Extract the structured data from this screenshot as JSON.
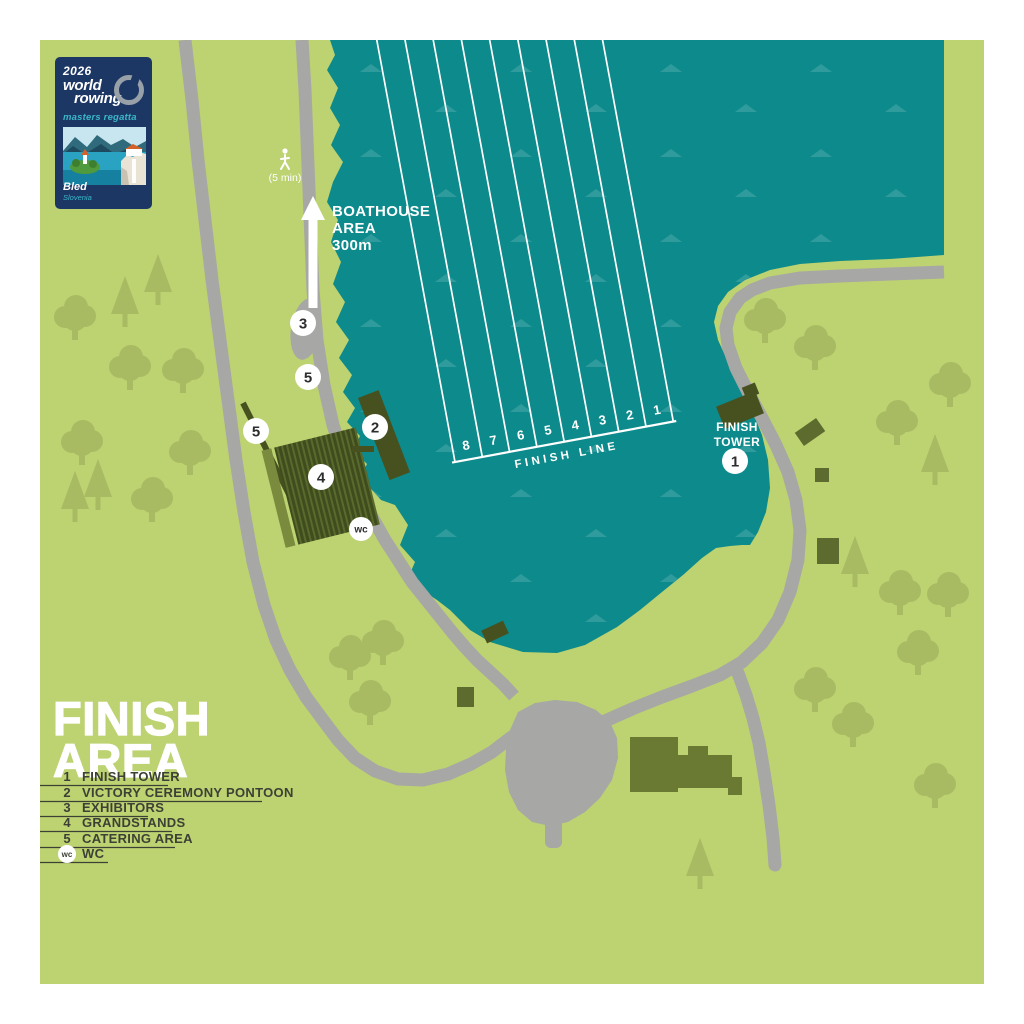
{
  "badge": {
    "year": "2026",
    "world": "world",
    "rowing": "rowing",
    "event": "masters regatta",
    "city": "Bled",
    "country": "Slovenia"
  },
  "labels": {
    "walk_time": "(5 min)",
    "boathouse_lines": [
      "BOATHOUSE",
      "AREA",
      "300m"
    ],
    "finish_line": "FINISH LINE",
    "finish_tower_lines": [
      "FINISH",
      "TOWER"
    ],
    "lane_numbers": [
      "8",
      "7",
      "6",
      "5",
      "4",
      "3",
      "2",
      "1"
    ]
  },
  "markers": {
    "finish_tower": "1",
    "victory_pontoon": "2",
    "exhibitors": "3",
    "grandstands": "4",
    "catering": "5",
    "wc": "wc"
  },
  "title": {
    "line1": "FINISH",
    "line2": "AREA"
  },
  "legend": {
    "items": [
      {
        "key": "1",
        "label": "FINISH TOWER"
      },
      {
        "key": "2",
        "label": "VICTORY CEREMONY PONTOON"
      },
      {
        "key": "3",
        "label": "EXHIBITORS"
      },
      {
        "key": "4",
        "label": "GRANDSTANDS"
      },
      {
        "key": "5",
        "label": "CATERING AREA"
      },
      {
        "key": "wc",
        "label": "WC"
      }
    ]
  },
  "colors": {
    "water": "#0d8a8b",
    "wave": "#2f9b9c",
    "grass": "#bdd271",
    "tree": "#a8bb62",
    "road": "#a7a7a5",
    "building_dark": "#47511f",
    "building_mid": "#6b7a33",
    "badge_navy": "#1d3765",
    "badge_teal": "#3ab7c8",
    "text_dark": "#3d4035",
    "white": "#ffffff"
  }
}
